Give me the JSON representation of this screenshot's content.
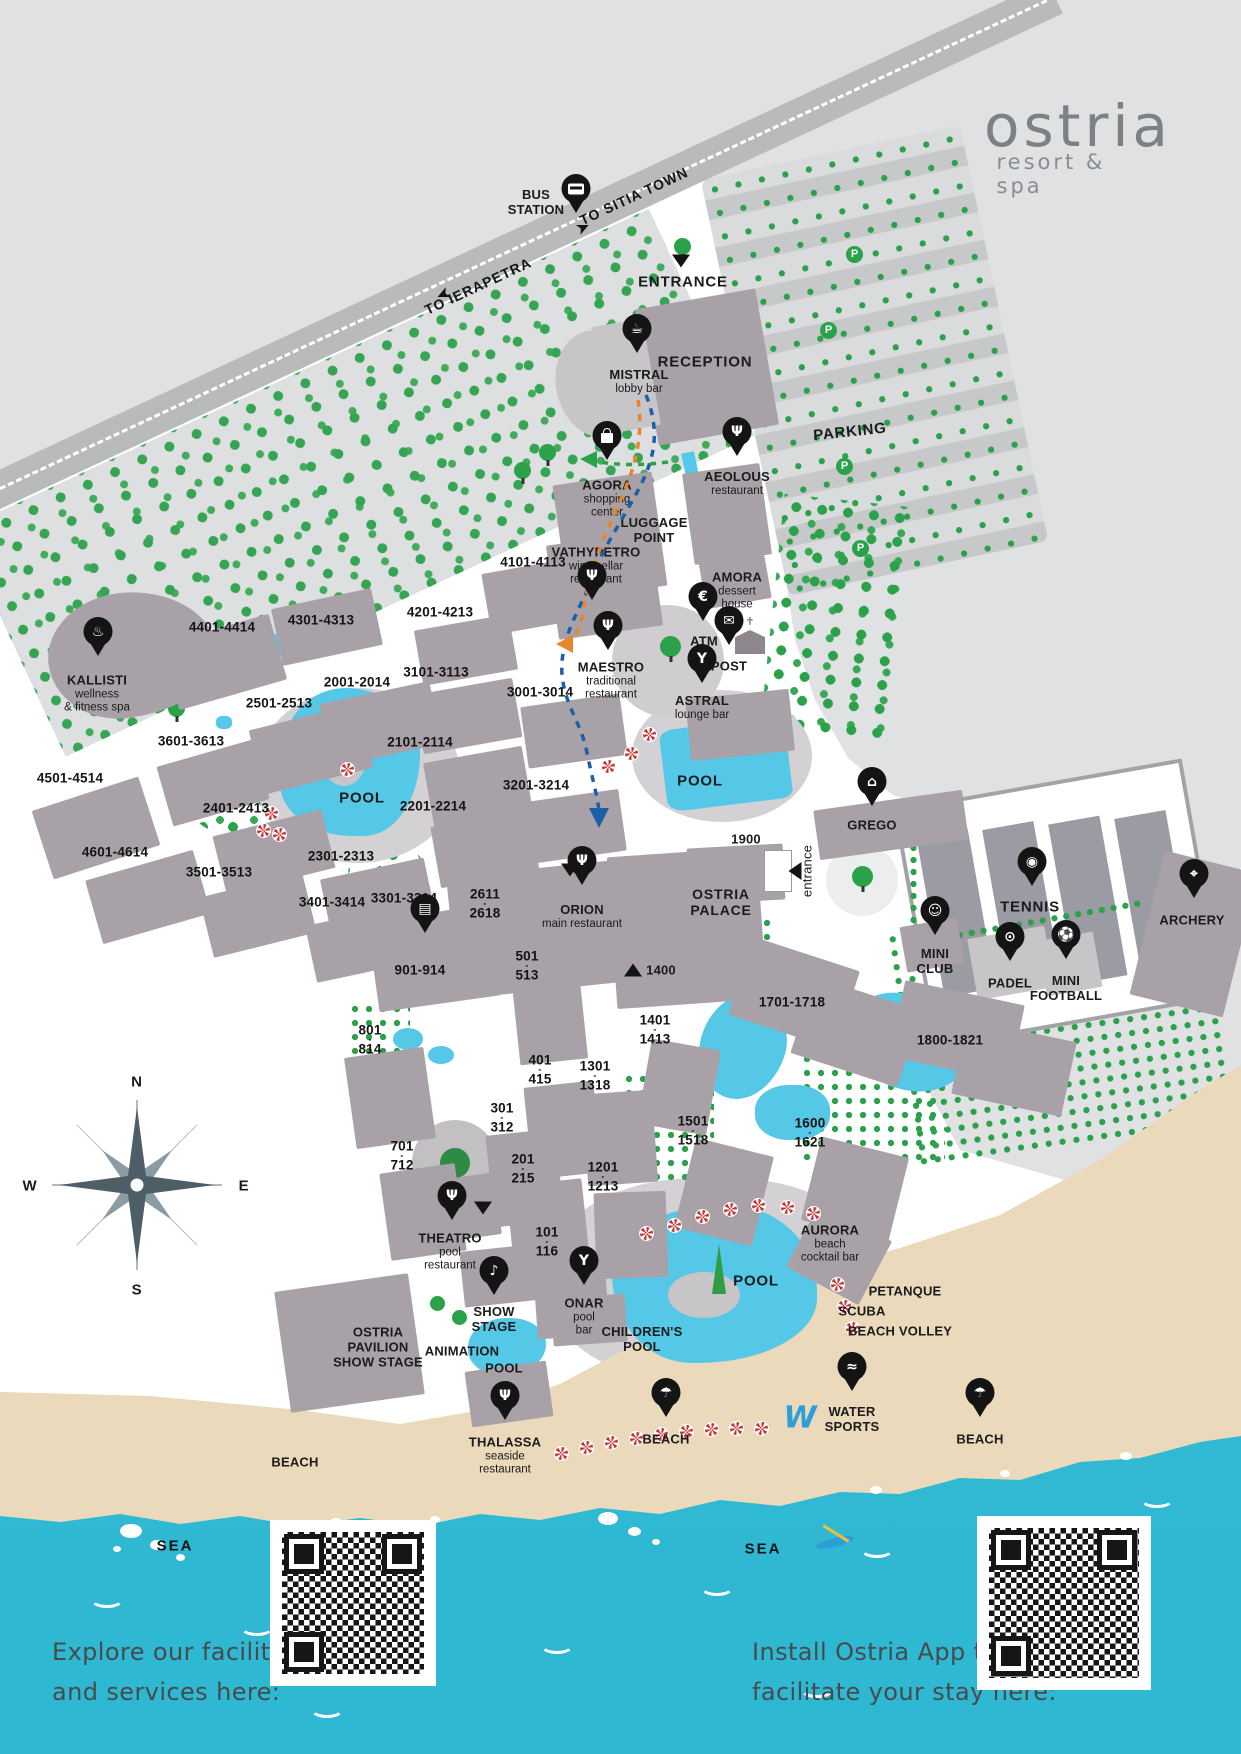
{
  "logo": {
    "name": "ostria",
    "tagline": "resort & spa"
  },
  "compass": {
    "n": "N",
    "e": "E",
    "s": "S",
    "w": "W"
  },
  "roads": {
    "to_sitia": "TO SITIA TOWN",
    "to_ierapetra": "TO IERAPETRA"
  },
  "top": {
    "bus_line1": "BUS",
    "bus_line2": "STATION",
    "entrance": "ENTRANCE",
    "reception": "RECEPTION",
    "parking": "PARKING",
    "p_badge": "P",
    "luggage_line1": "LUGGAGE",
    "luggage_line2": "POINT"
  },
  "facilities": {
    "mistral": {
      "name": "MISTRAL",
      "sub": "lobby bar",
      "icon": "coffee-cup-icon"
    },
    "agora": {
      "name": "AGORA",
      "sub1": "shopping",
      "sub2": "center",
      "icon": "shopping-bag-icon"
    },
    "aeolous": {
      "name": "AEOLOUS",
      "sub": "restaurant",
      "icon": "restaurant-icon"
    },
    "vathypetro": {
      "name": "VATHYPETRO",
      "sub1": "wine cellar",
      "sub2": "restaurant",
      "icon": "restaurant-icon"
    },
    "amora": {
      "name": "AMORA",
      "sub1": "dessert",
      "sub2": "house"
    },
    "maestro": {
      "name": "MAESTRO",
      "sub1": "traditional",
      "sub2": "restaurant",
      "icon": "restaurant-icon"
    },
    "astral": {
      "name": "ASTRAL",
      "sub": "lounge bar",
      "icon": "cocktail-icon"
    },
    "kallisti": {
      "name": "KALLISTI",
      "sub1": "wellness",
      "sub2": "& fitness spa",
      "icon": "spa-icon"
    },
    "orion": {
      "name": "ORION",
      "sub": "main restaurant",
      "icon": "restaurant-icon"
    },
    "ostria_palace": {
      "line1": "OSTRIA",
      "line2": "PALACE"
    },
    "grego": {
      "name": "GREGO",
      "icon": "taverna-icon"
    },
    "theatro": {
      "name": "THEATRO",
      "sub1": "pool",
      "sub2": "restaurant",
      "icon": "restaurant-icon"
    },
    "show_stage": {
      "line1": "SHOW",
      "line2": "STAGE",
      "icon": "microphone-icon"
    },
    "onar": {
      "name": "ONAR",
      "sub1": "pool",
      "sub2": "bar",
      "icon": "cocktail-icon"
    },
    "aurora": {
      "name": "AURORA",
      "sub1": "beach",
      "sub2": "cocktail bar"
    },
    "thalassa": {
      "name": "THALASSA",
      "sub1": "seaside",
      "sub2": "restaurant",
      "icon": "restaurant-icon"
    },
    "ostria_pavilion": {
      "line1": "OSTRIA",
      "line2": "PAVILION",
      "line3": "SHOW STAGE"
    },
    "animation": {
      "name": "ANIMATION"
    },
    "atm": {
      "name": "ATM",
      "icon": "atm-icon"
    },
    "post": {
      "name": "POST",
      "icon": "mail-icon"
    }
  },
  "sports": {
    "tennis": "TENNIS",
    "padel": "PADEL",
    "mini_club_1": "MINI",
    "mini_club_2": "CLUB",
    "mini_football_1": "MINI",
    "mini_football_2": "FOOTBALL",
    "archery": "ARCHERY",
    "petanque": "PETANQUE",
    "scuba": "SCUBA",
    "beach_volley": "BEACH VOLLEY",
    "water_sports_1": "WATER",
    "water_sports_2": "SPORTS",
    "water_sports_logo": "W"
  },
  "areas": {
    "pool": "POOL",
    "children_1": "CHILDREN'S",
    "children_2": "POOL",
    "beach": "BEACH",
    "sea": "SEA",
    "entrance_side": "entrance",
    "n1900": "1900",
    "n1400": "1400"
  },
  "rooms": [
    "4101-4113",
    "4401-4414",
    "4301-4313",
    "4201-4213",
    "2001-2014",
    "3101-3113",
    "2501-2513",
    "3601-3613",
    "2101-2114",
    "4501-4514",
    "2401-2413",
    "2201-2214",
    "4601-4614",
    "3501-3513",
    "2301-2313",
    "3401-3414",
    "3301-3314",
    "3001-3014",
    "3201-3214",
    "901-914",
    "1701-1718",
    "1800-1821"
  ],
  "rooms_stacked": [
    {
      "t": "2611",
      "b": "2618"
    },
    {
      "t": "501",
      "b": "513"
    },
    {
      "t": "1401",
      "b": "1413"
    },
    {
      "t": "801",
      "b": "814"
    },
    {
      "t": "401",
      "b": "415"
    },
    {
      "t": "1301",
      "b": "1318"
    },
    {
      "t": "301",
      "b": "312"
    },
    {
      "t": "1501",
      "b": "1518"
    },
    {
      "t": "1600",
      "b": "1621"
    },
    {
      "t": "701",
      "b": "712"
    },
    {
      "t": "201",
      "b": "215"
    },
    {
      "t": "1201",
      "b": "1213"
    },
    {
      "t": "101",
      "b": "116"
    }
  ],
  "icons": {
    "coffee": "☕",
    "restaurant": "Ψ",
    "cocktail": "Y",
    "spa": "♨",
    "atm": "€",
    "post": "✉",
    "mic": "♪",
    "tennis": "◉",
    "padel": "⊙",
    "football": "⚽",
    "teddy": "☺",
    "archery": "⌖",
    "taverna": "⌂",
    "umbrella": "☂",
    "watersports": "≈",
    "market": "▤",
    "arrow": "➤",
    "cross": "✝"
  },
  "footer": {
    "left1": "Explore our facilities",
    "left2": "and services here:",
    "right1": "Install Ostria App to",
    "right2": "facilitate your stay here:"
  },
  "colors": {
    "sea": "#35bdd6",
    "sand": "#ead9ba",
    "pool": "#55c8e8",
    "building": "#a8a1a7",
    "building_light": "#c8c5c8",
    "tree": "#2ba14a",
    "road": "#b8babc",
    "background": "#dfe1e3",
    "pin": "#141414",
    "umbrella_red": "#c43434",
    "path_blue": "#1b5fa8",
    "path_orange": "#e8862c",
    "logo_gray": "#7e8184"
  }
}
